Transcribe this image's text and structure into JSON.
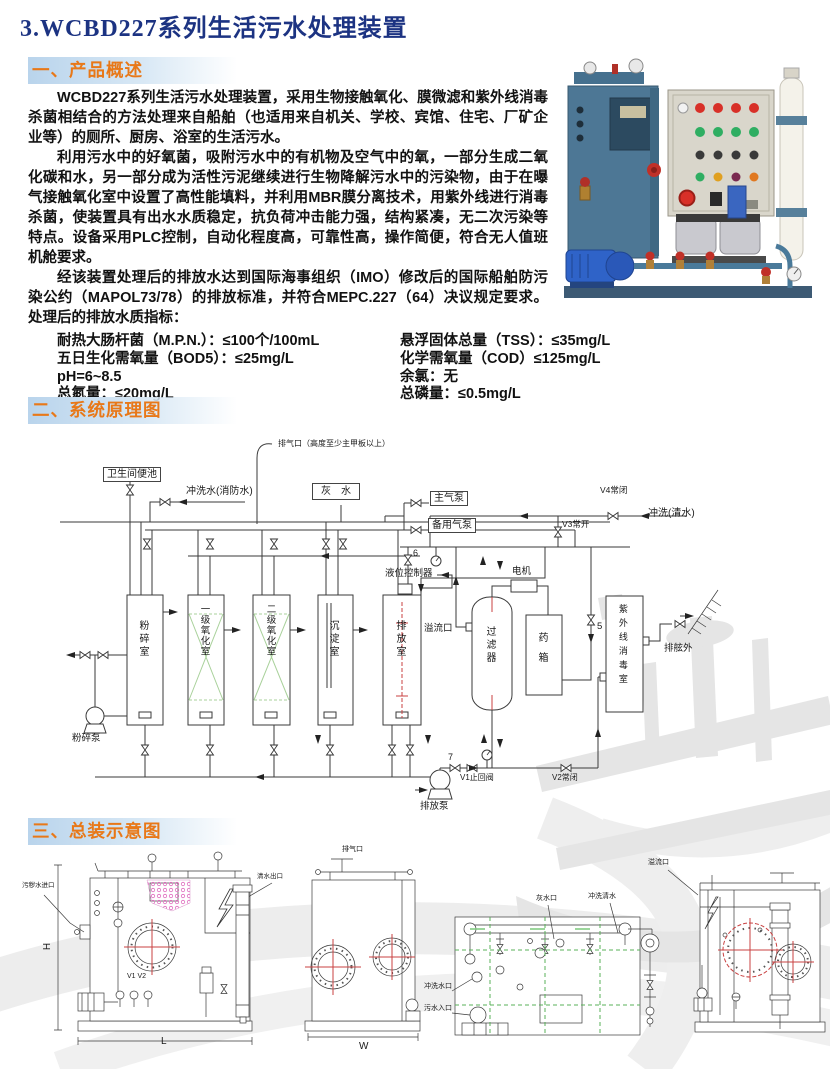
{
  "page_title": "3.WCBD227系列生活污水处理装置",
  "section1": {
    "heading": "一、产品概述"
  },
  "section2": {
    "heading": "二、系统原理图"
  },
  "section3": {
    "heading": "三、总装示意图"
  },
  "overview": {
    "p1": "WCBD227系列生活污水处理装置，采用生物接触氧化、膜微滤和紫外线消毒杀菌相结合的方法处理来自船舶（也适用来自机关、学校、宾馆、住宅、厂矿企业等）的厕所、厨房、浴室的生活污水。",
    "p2": "利用污水中的好氧菌，吸附污水中的有机物及空气中的氧，一部分生成二氧化碳和水，另一部分成为活性污泥继续进行生物降解污水中的污染物，由于在曝气接触氧化室中设置了高性能填料，并利用MBR膜分离技术，用紫外线进行消毒杀菌，使装置具有出水水质稳定，抗负荷冲击能力强，结构紧凑，无二次污染等特点。设备采用PLC控制，自动化程度高，可靠性高，操作简便，符合无人值班机舱要求。",
    "p3": "经该装置处理后的排放水达到国际海事组织（IMO）修改后的国际船舶防污染公约（MAPOL73/78）的排放标准，并符合MEPC.227（64）决议规定要求。处理后的排放水质指标：",
    "specs_left": [
      "耐热大肠杆菌（M.P.N.）：≤100个/100mL",
      "五日生化需氧量（BOD5）：≤25mg/L",
      "pH=6~8.5",
      "总氮量：≤20mg/L"
    ],
    "specs_right": [
      "悬浮固体总量（TSS）：≤35mg/L",
      "化学需氧量（COD）≤125mg/L",
      "余氯：无",
      "总磷量：≤0.5mg/L"
    ]
  },
  "schematic": {
    "labels": {
      "vent": "排气口（高度至少主甲板以上）",
      "toilet": "卫生间便池",
      "flush_fire": "冲洗水(消防水)",
      "gray_water": "灰　水",
      "main_air_pump": "主气泵",
      "backup_air_pump": "备用气泵",
      "v4": "V4常闭",
      "flush_clean": "冲洗(清水)",
      "v3": "V3常开",
      "num6": "6",
      "level_controller": "液位控制器",
      "motor": "电机",
      "tank_crush": "粉碎室",
      "tank_ox1": "一级氧化室",
      "tank_ox2": "二级氧化室",
      "tank_settle": "沉淀室",
      "tank_discharge": "排放室",
      "overflow": "溢流口",
      "filter": "过滤器",
      "dosing_box": "药箱",
      "num5": "5",
      "uv_chamber": "紫外线消毒室",
      "overboard": "排舷外",
      "crusher_pump": "粉碎泵",
      "discharge_pump": "排放泵",
      "num7": "7",
      "v1": "V1止回阀",
      "v2": "V2常闭"
    }
  },
  "assembly": {
    "labels": {
      "sewage_inlet": "污秽水进口",
      "clean_out": "清水出口",
      "v1v2": "V1 V2",
      "dim_h": "H",
      "dim_l": "L",
      "dim_w": "W",
      "vent": "排气口",
      "gray_port": "灰水口",
      "flush_clean": "冲洗清水",
      "flush_port": "冲洗水口",
      "sewage_in": "污水入口",
      "overflow": "溢流口"
    }
  },
  "colors": {
    "title_navy": "#1c3382",
    "section_orange": "#e87818",
    "section_bar_blue": "#b9d4ec",
    "diagram_green": "#a9d19b",
    "diagram_red": "#c84040"
  }
}
